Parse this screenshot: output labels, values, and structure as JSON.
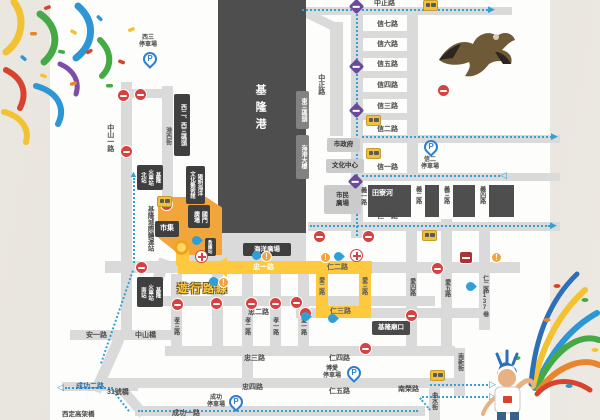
{
  "map_title": "基隆遊行路線圖",
  "route": {
    "name": "遊行路線",
    "zhong1": "忠一路",
    "ren2": "仁二路",
    "ren3": "仁三路",
    "ai2": "愛二路",
    "ai3": "愛三路"
  },
  "labels": {
    "keelung_harbor": "基隆港",
    "tianliao_river": "田寮河",
    "zhongzheng_top": "中正路",
    "zhongzheng_v": "中正路",
    "xin7": "信七路",
    "xin6": "信六路",
    "xin5": "信五路",
    "xin4": "信四路",
    "xin3": "信三路",
    "xin2": "信二路",
    "xin1": "信一路",
    "ren1": "仁一路",
    "ren4": "仁四路",
    "ren5": "仁五路",
    "ren2_lane137": "仁二路137巷",
    "yi1": "義一路",
    "yi2": "義二路",
    "yi3": "義三路",
    "yi4": "義四路",
    "ai1": "愛一路",
    "ai4": "愛四路",
    "ai5": "愛五路",
    "xiao1": "孝一路",
    "xiao2": "孝二路",
    "xiao3": "孝三路",
    "zhong2": "忠二路",
    "zhong3": "忠三路",
    "zhong4": "忠四路",
    "zhongshan1": "中山一路",
    "zhongshan_bridge": "中山橋",
    "an1": "安一路",
    "gangxi": "港西街",
    "chenggong1": "成功一路",
    "chenggong2": "成功二路",
    "bridge31": "31號橋",
    "xiding_viaduct": "西定高架橋",
    "nanrong": "南榮路",
    "nanxin": "南新街",
    "qushui": "曲水街"
  },
  "badges": {
    "pier_w23": "西二、西三碼頭",
    "pier_e3": "東三碼頭",
    "harbor_building": "海港大樓",
    "yangming_museum": [
      "陽明海洋",
      "文化藝術館"
    ],
    "station_north": [
      "基隆",
      "火車站",
      "北站"
    ],
    "station_south": [
      "基隆",
      "火車站",
      "南站"
    ],
    "intercity_terminal": "基隆城際轉運站",
    "guomen_plaza": [
      "國門",
      "廣場"
    ],
    "market": "市集",
    "first_aid": "救護站",
    "ocean_plaza": "海洋廣場",
    "miaokou": "基隆廟口",
    "city_hall": "市政府",
    "culture_center": "文化中心",
    "civic_plaza": [
      "市民",
      "廣場"
    ]
  },
  "parking": {
    "p": "P",
    "west3": [
      "西三",
      "停車場"
    ],
    "xin2": [
      "信二",
      "停車場"
    ],
    "chenggong": [
      "成功",
      "停車場"
    ],
    "boai": [
      "博愛",
      "停車場"
    ]
  },
  "icons": {
    "alert": "!",
    "tri_right": "▶",
    "tri_left": "◀",
    "tri_up": "▲",
    "tri_right_open": "▷",
    "tri_left_open": "◁"
  }
}
